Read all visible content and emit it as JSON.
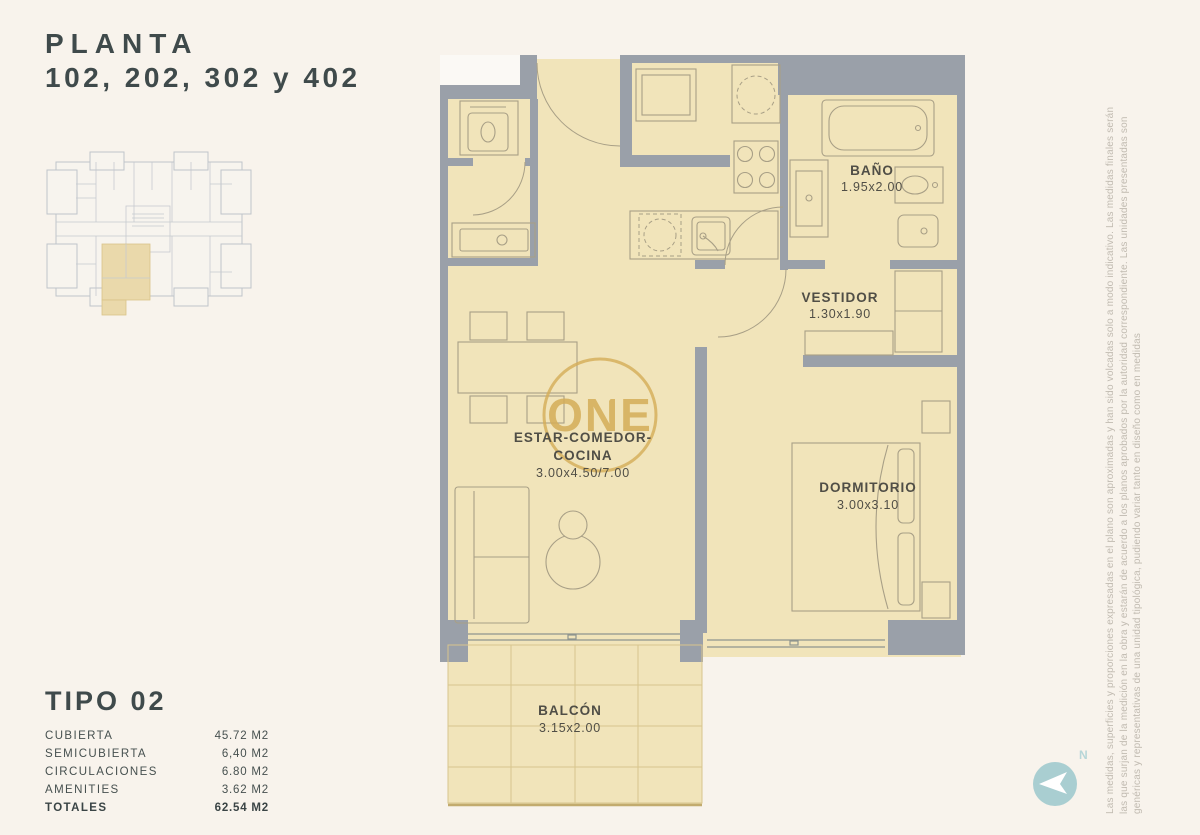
{
  "title": {
    "line1": "PLANTA",
    "line2": "102, 202, 302 y 402"
  },
  "logo": {
    "text": "ONE"
  },
  "rooms": {
    "bano": {
      "name": "BAÑO",
      "dims": "1.95x2.00"
    },
    "vestidor": {
      "name": "VESTIDOR",
      "dims": "1.30x1.90"
    },
    "estar": {
      "line1": "ESTAR-COMEDOR-",
      "line2": "COCINA",
      "dims": "3.00x4.50/7.00"
    },
    "dormitorio": {
      "name": "DORMITORIO",
      "dims": "3.00x3.10"
    },
    "balcon": {
      "name": "BALCÓN",
      "dims": "3.15x2.00"
    }
  },
  "summary": {
    "heading": "TIPO 02",
    "rows": [
      {
        "label": "CUBIERTA",
        "value": "45.72 M2"
      },
      {
        "label": "SEMICUBIERTA",
        "value": "6,40 M2"
      },
      {
        "label": "CIRCULACIONES",
        "value": "6.80 M2"
      },
      {
        "label": "AMENITIES",
        "value": "3.62 M2"
      },
      {
        "label": "TOTALES",
        "value": "62.54 M2"
      }
    ]
  },
  "disclaimer": {
    "line1": "Las medidas, superficies y proporciones expresadas en el plano son aproximadas y han sido volcadas solo a modo indicativo. Las medidas finales serán",
    "line2": "las que surjan de la medición en la obra y estarán de acuerdo a los planos aprobados por la autoridad correspondiente. Las unidades presentadas son",
    "line3": "genéricas y representativas de una unidad tipológica, pudiendo variar tanto en diseño como en medidas"
  },
  "compass": {
    "north_label": "N"
  },
  "colors": {
    "page_bg": "#f8f3ec",
    "floor_beige": "#f1e4ba",
    "wall_gray": "#9aa0a9",
    "logo_gold": "#d4ad58",
    "compass_teal": "#a9ced1",
    "text_dark": "#3f4a4b"
  }
}
